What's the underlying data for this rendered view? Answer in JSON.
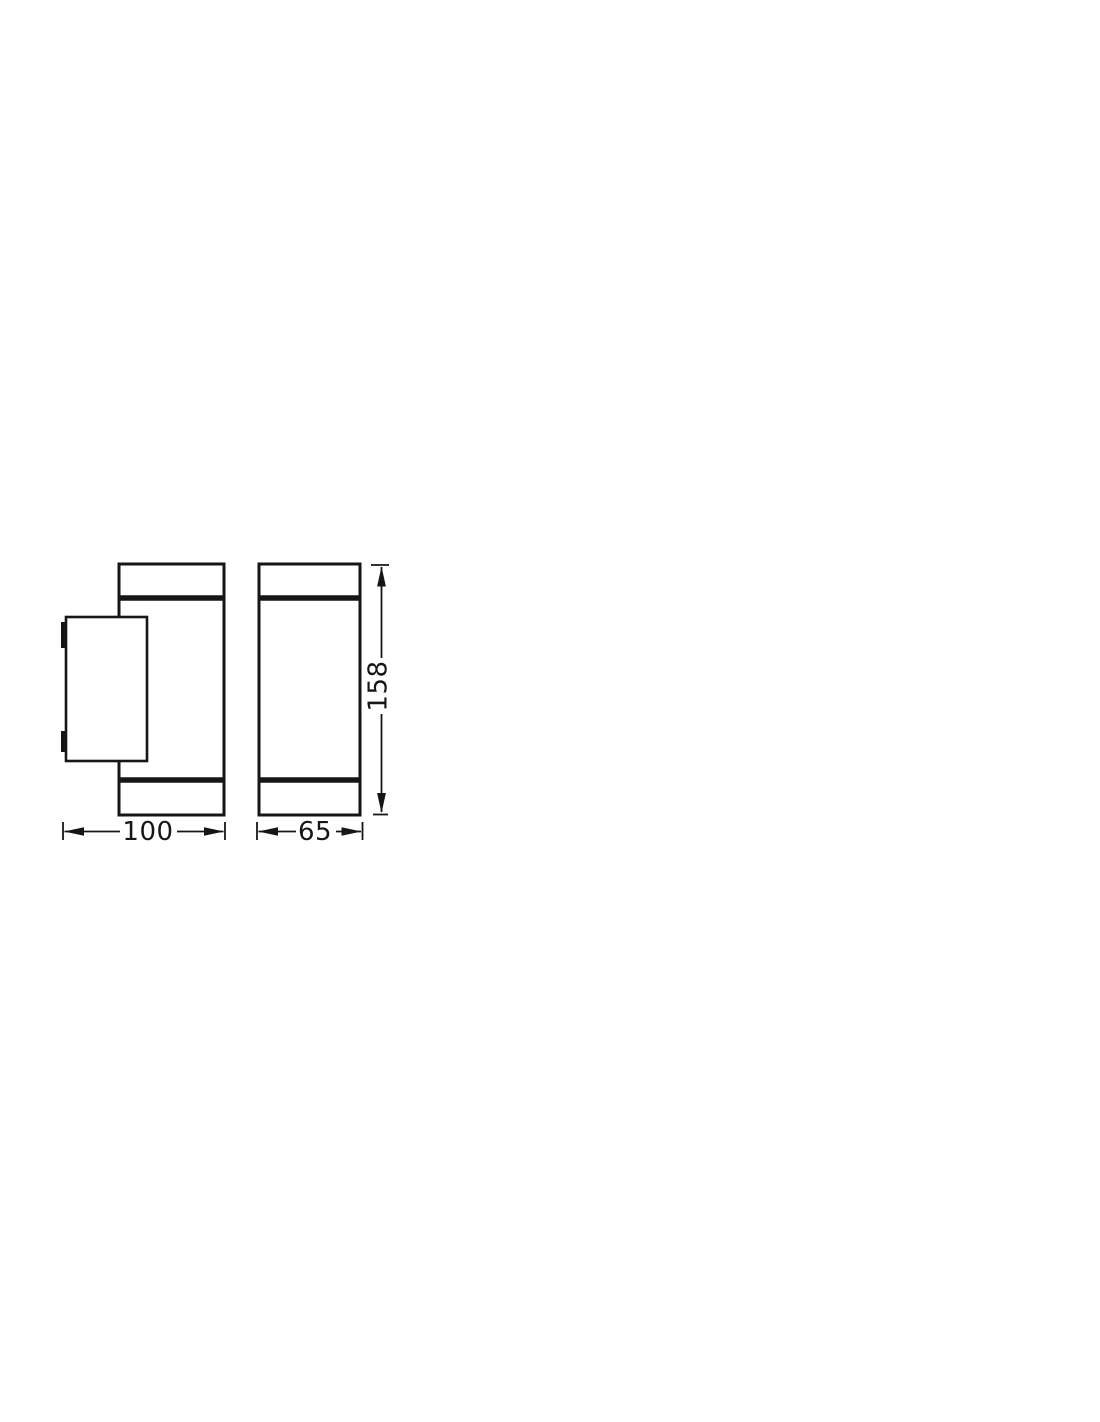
{
  "colors": {
    "background": "#ffffff",
    "line": "#161616"
  },
  "drawing": {
    "type": "product-dimension-diagram",
    "views": [
      "side-view-with-wall-plate",
      "front-view"
    ],
    "dimensions": {
      "width": "100",
      "depth": "65",
      "height": "158"
    }
  }
}
